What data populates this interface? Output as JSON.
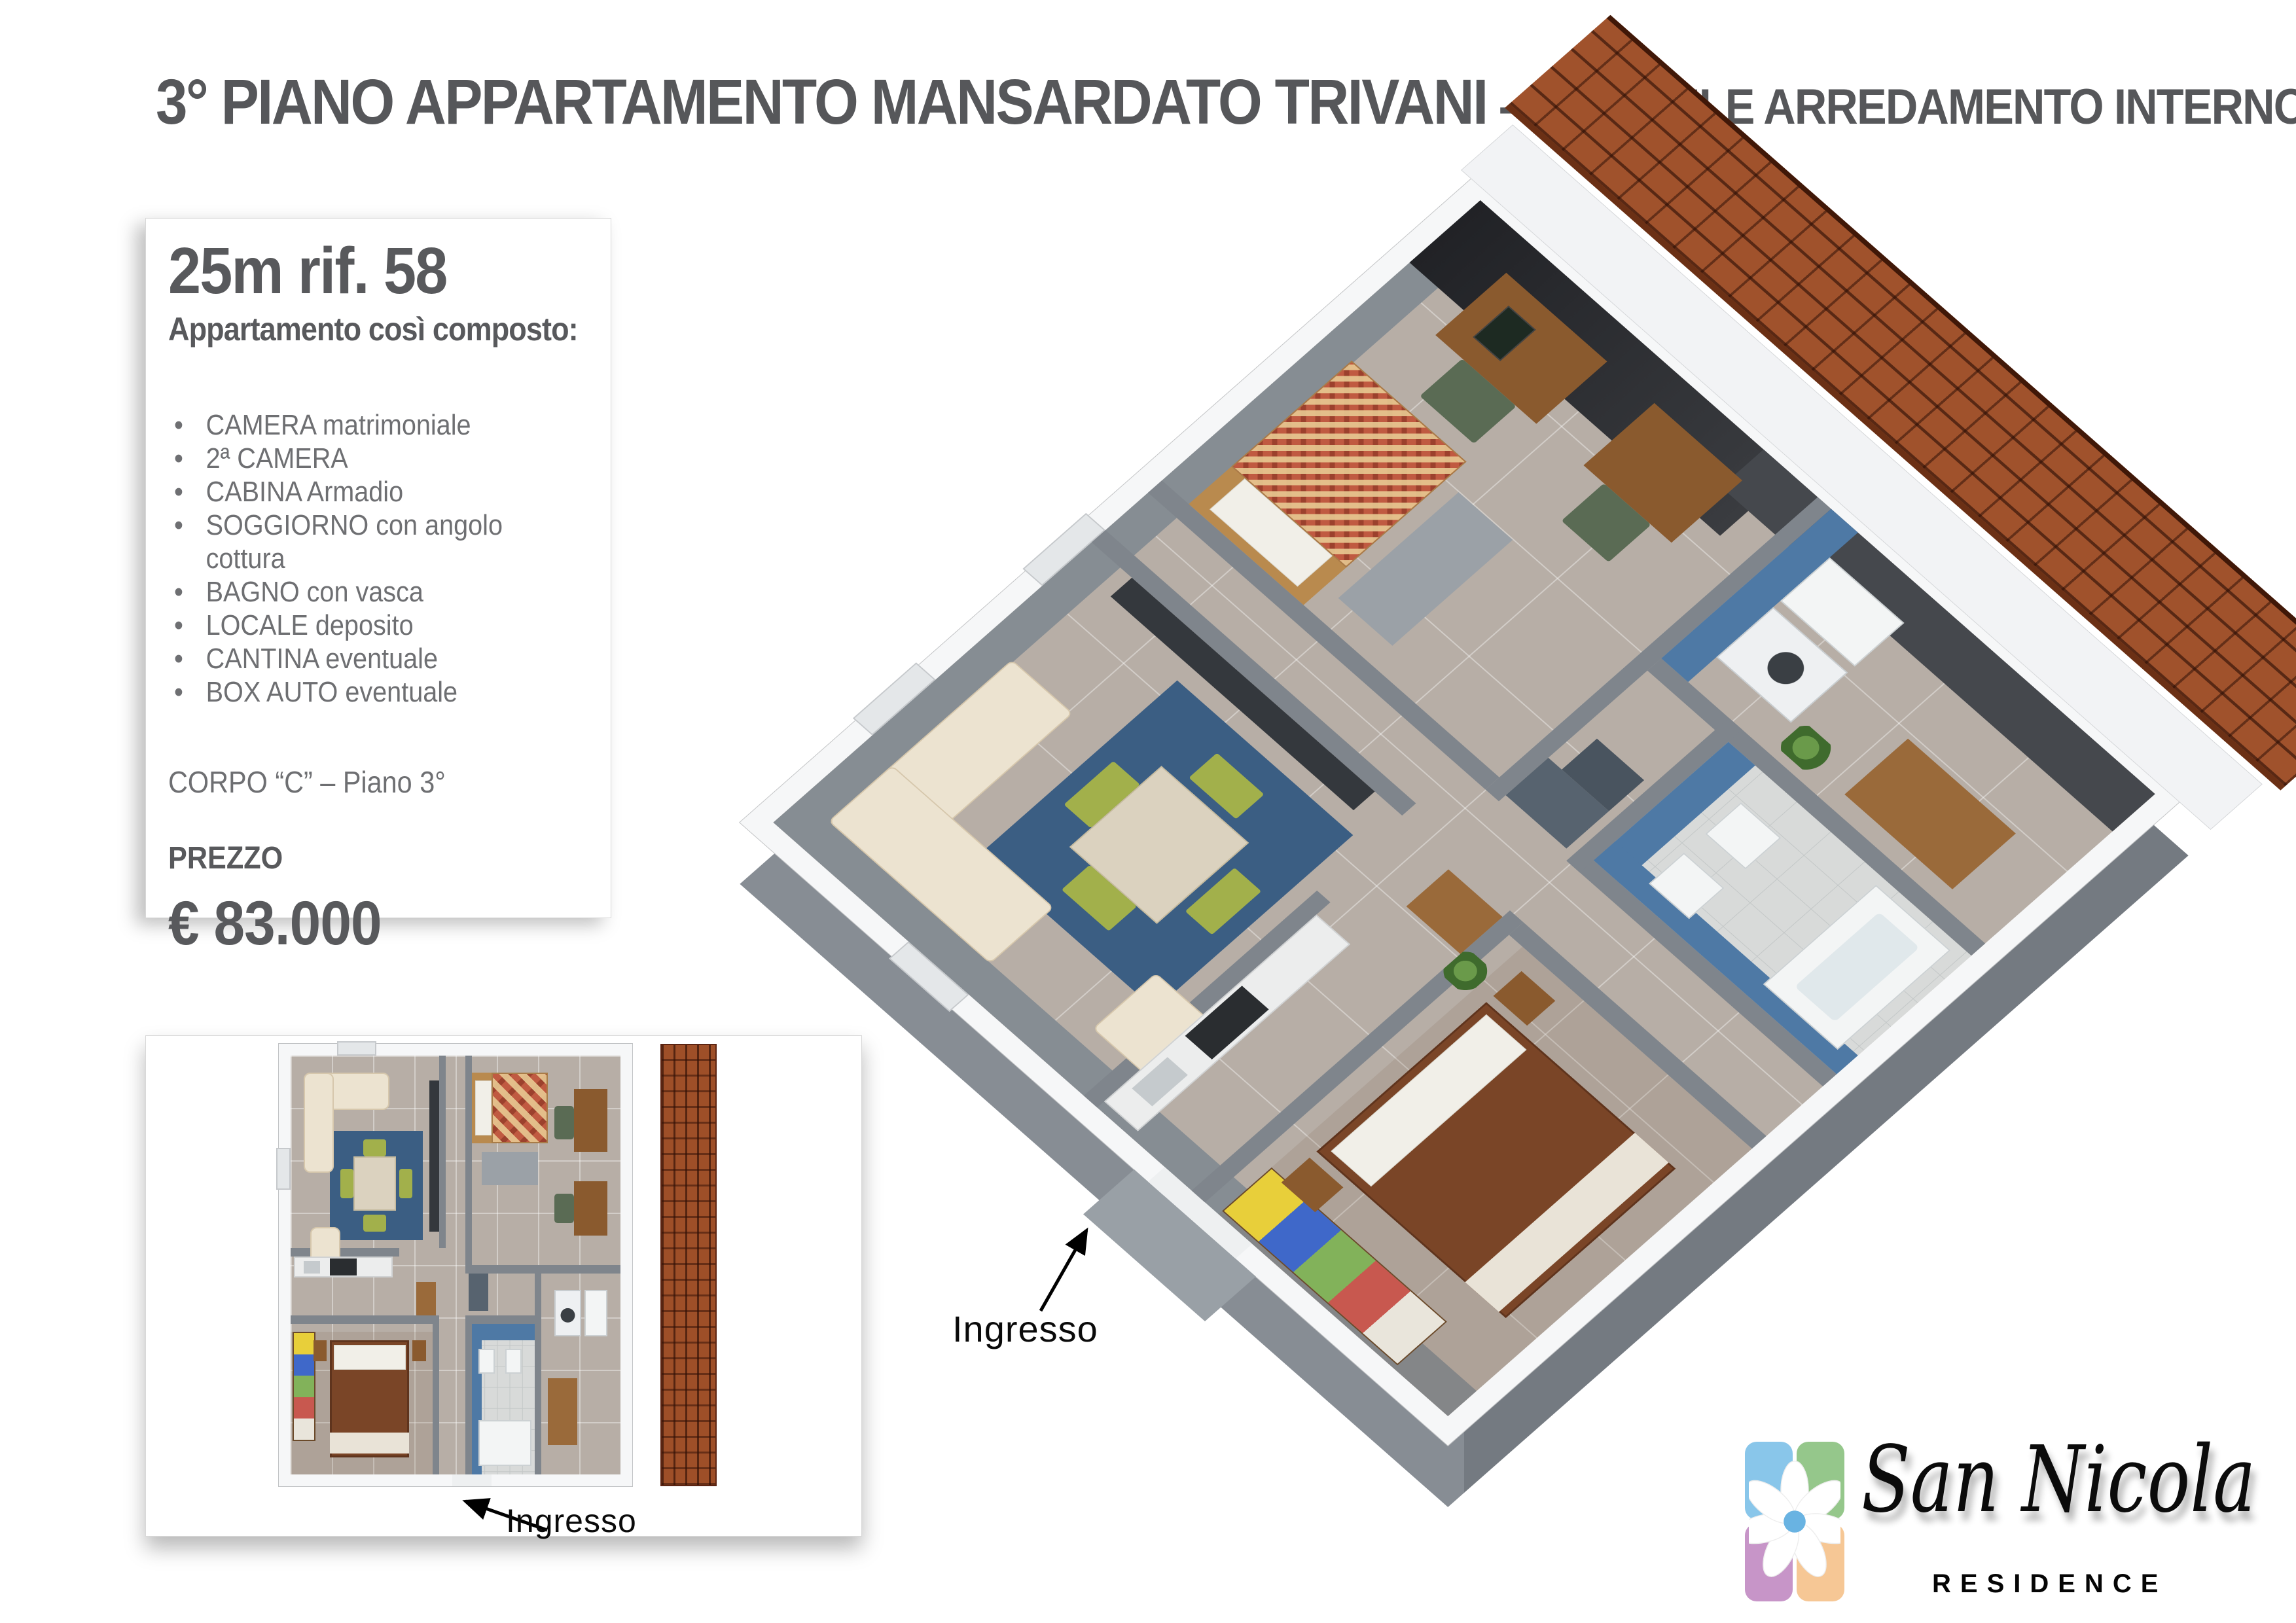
{
  "title": {
    "main": "3° PIANO APPARTAMENTO MANSARDATO TRIVANI",
    "sep": "-",
    "sub": "POSSIBILE ARREDAMENTO INTERNO"
  },
  "info_card": {
    "reference": "25m rif. 58",
    "subtitle": "Appartamento così composto:",
    "features": [
      "CAMERA matrimoniale",
      "2ª CAMERA",
      "CABINA Armadio",
      "SOGGIORNO con angolo cottura",
      "BAGNO con vasca",
      "LOCALE deposito",
      "CANTINA eventuale",
      "BOX AUTO eventuale"
    ],
    "building": "CORPO “C” – Piano 3°",
    "price_label": "PREZZO",
    "price": "€ 83.000"
  },
  "plan_3d": {
    "entrance_label": "Ingresso"
  },
  "plan_thumb": {
    "entrance_label": "Ingresso"
  },
  "logo": {
    "name": "San Nicola",
    "subtitle": "RESIDENCE",
    "tiles": {
      "blue": "#89c6ea",
      "green": "#95c78b",
      "purple": "#c795c8",
      "orange": "#f6c795"
    },
    "flower_center": "#69b3e2"
  }
}
